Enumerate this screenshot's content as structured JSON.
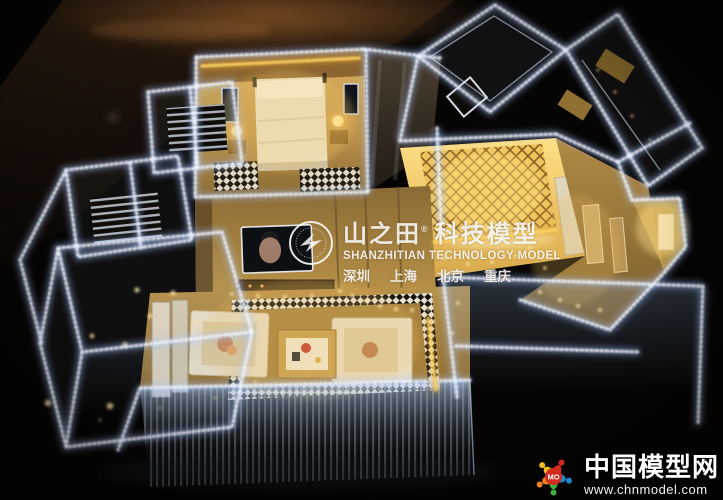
{
  "image": {
    "kind": "photograph",
    "subject": "Illuminated miniature apartment scale model with LED-edged acrylic walls displayed on a dark table"
  },
  "watermark_center": {
    "brand_cn": "山之田",
    "reg_mark": "®",
    "brand_suffix_cn": "科技模型",
    "brand_en": "SHANZHITIAN TECHNOLOGY MODEL",
    "cities": [
      "深圳",
      "上海",
      "北京",
      "重庆"
    ]
  },
  "watermark_corner": {
    "logo_text": "MO",
    "site_name_cn": "中国模型网",
    "site_url": "www.chnmodel.com"
  },
  "palette": {
    "background": "#070503",
    "table_glow": "#7a4d22",
    "led_white": "#f4f8ff",
    "led_warm_yellow": "#ffd866",
    "room_gold": "#c9a14e",
    "room_gold_bright": "#ffe084",
    "lamp_glow": "#ffe9a8",
    "sofa_cream": "#e9dec6",
    "watermark_white": "#ffffff",
    "corner_logo_red": "#d42b1e",
    "corner_logo_blue": "#1e88c7",
    "corner_logo_green": "#3faf3f",
    "corner_logo_orange": "#f08020",
    "corner_logo_yellow": "#f0c020"
  }
}
